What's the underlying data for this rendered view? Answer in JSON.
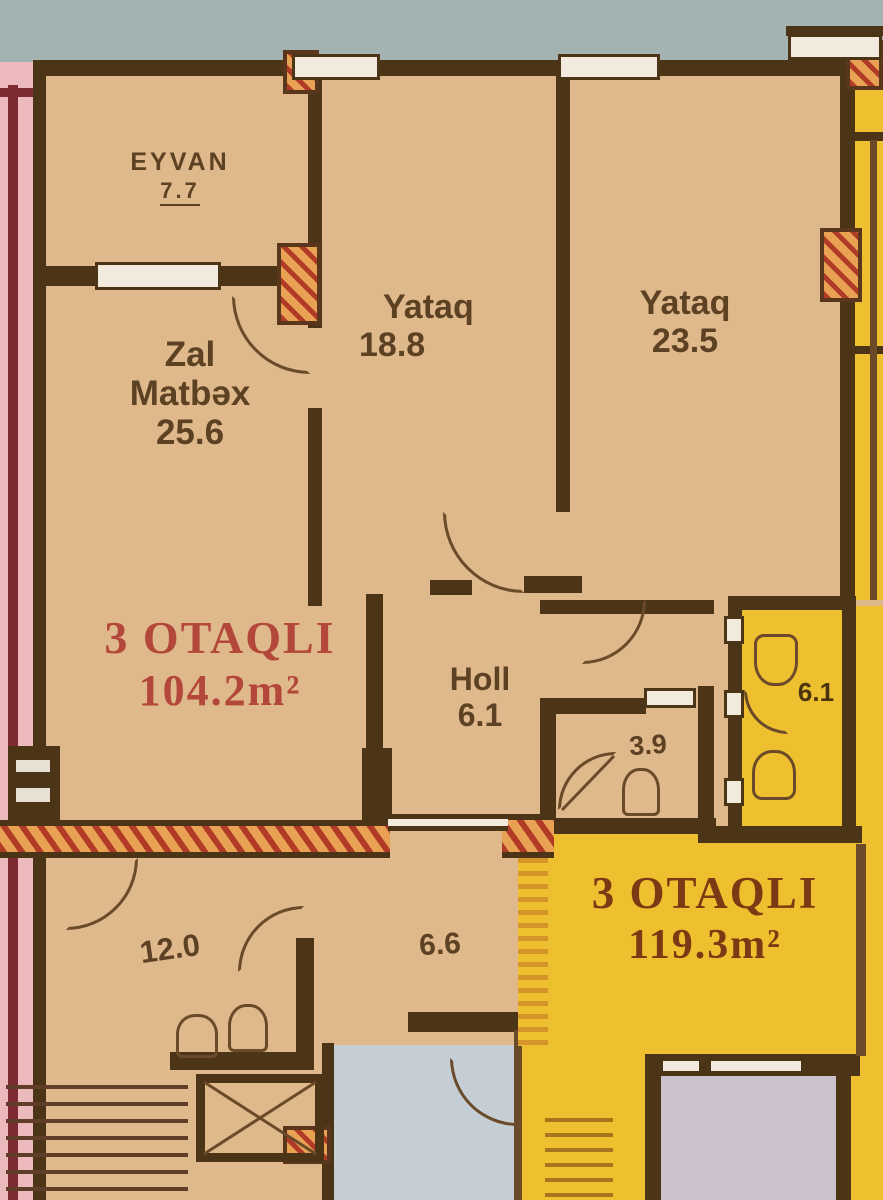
{
  "plan_title": "Apartment floor plan",
  "apartments": {
    "a": {
      "type": "3 OTAQLI",
      "area": "104.2m²"
    },
    "b": {
      "type": "3 OTAQLI",
      "area": "119.3m²"
    }
  },
  "rooms": {
    "eyvan": {
      "label": "EYVAN",
      "area": "7.7"
    },
    "zal": {
      "line1": "Zal",
      "line2": "Matbəx",
      "area": "25.6"
    },
    "yataq1": {
      "label": "Yataq",
      "area": "18.8"
    },
    "yataq2": {
      "label": "Yataq",
      "area": "23.5"
    },
    "holl": {
      "label": "Holl",
      "area": "6.1"
    },
    "santex": {
      "area": "3.9"
    },
    "room_12": {
      "area": "12.0"
    },
    "room_66": {
      "area": "6.6"
    },
    "bath_b": {
      "area": "6.1"
    }
  },
  "colors": {
    "wall": "#4c3416",
    "tan": "#dfb88c",
    "pink": "#ecbabc",
    "yellow": "#eec02f",
    "sky": "#a2b3b1",
    "red_label": "#b2473a",
    "dark_red_label": "#7c3a14",
    "hatch_red": "#b23b28",
    "hatch_orange": "#e9a254",
    "blue_room": "#c5ced4",
    "lavender_room": "#cdc1cd"
  }
}
